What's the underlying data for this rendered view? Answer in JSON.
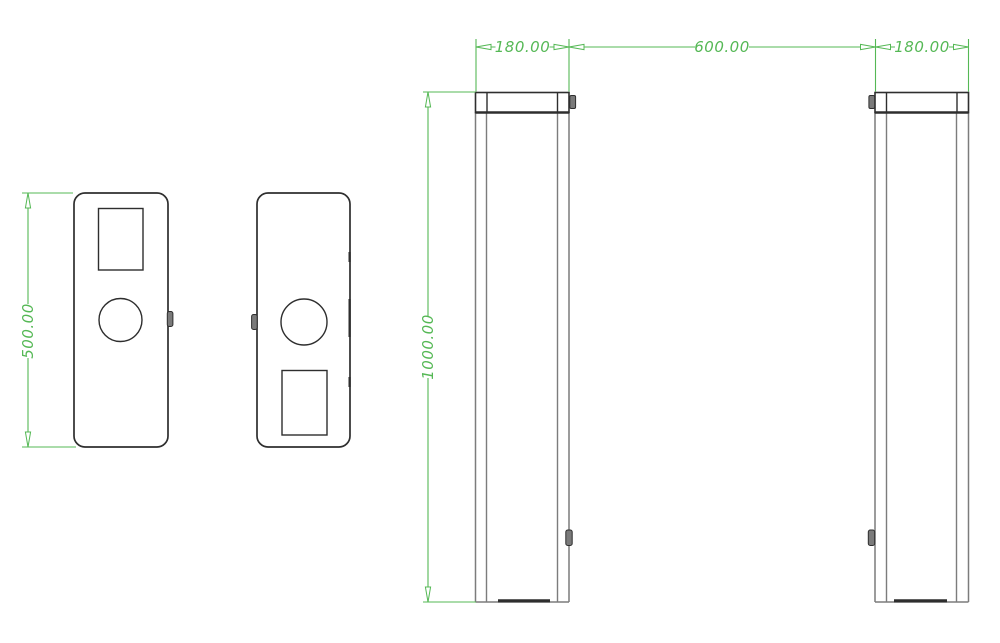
{
  "colors": {
    "dimension_green": "#55b855",
    "line_dark": "#2e2e2e",
    "line_gray": "#7c7c7c",
    "background": "#ffffff"
  },
  "drawing": {
    "top_view": {
      "length_label": "500.00"
    },
    "front_view": {
      "left_pillar_width_label": "180.00",
      "passage_width_label": "600.00",
      "right_pillar_width_label": "180.00",
      "pillar_height_label": "1000.00"
    }
  }
}
